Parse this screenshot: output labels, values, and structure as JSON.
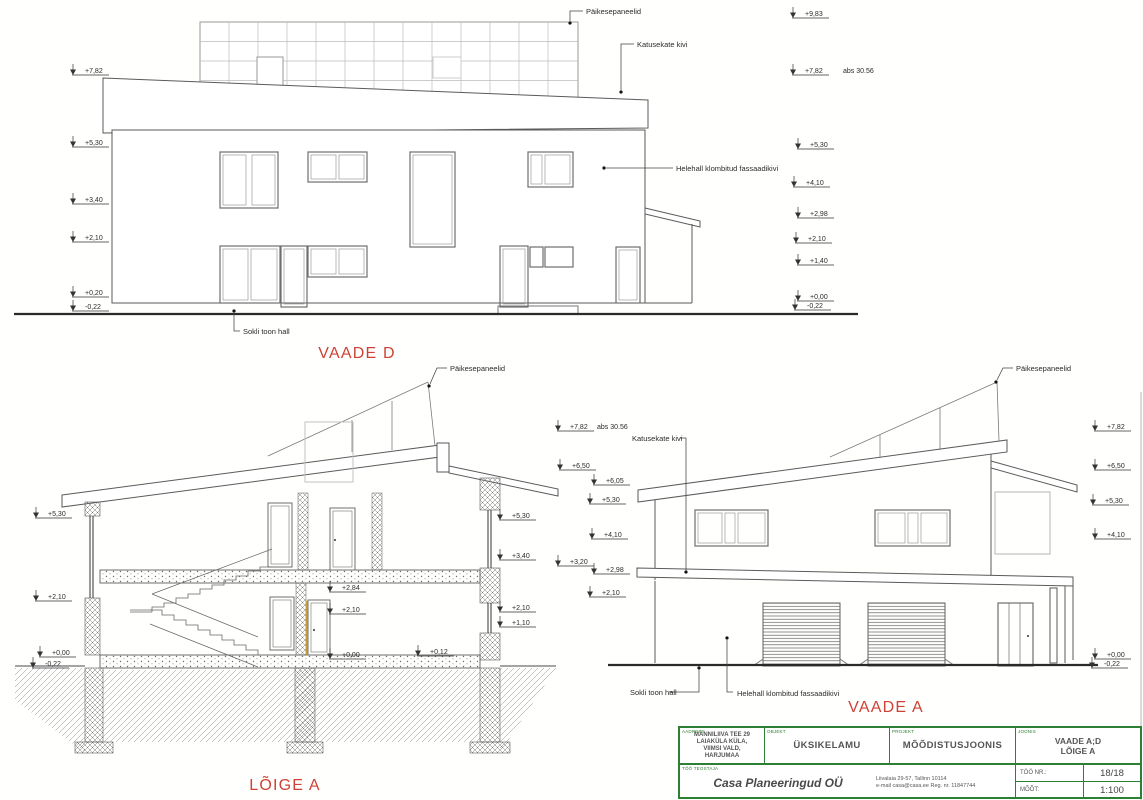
{
  "sheet": {
    "kind": "architectural measurement drawing",
    "scale": "1:100"
  },
  "colors": {
    "red_label": "#cf4136",
    "green_border": "#2c7f33",
    "line": "#5a5a5a",
    "accent_wood": "#cc9922"
  },
  "annotations": {
    "level_marks": [
      {
        "t": "+7,82",
        "x": 85,
        "y": 73
      },
      {
        "t": "+5,30",
        "x": 85,
        "y": 145
      },
      {
        "t": "+3,40",
        "x": 85,
        "y": 202
      },
      {
        "t": "+2,10",
        "x": 85,
        "y": 240
      },
      {
        "t": "+0,20",
        "x": 85,
        "y": 295
      },
      {
        "t": "-0,22",
        "x": 85,
        "y": 309
      },
      {
        "t": "+9,83",
        "x": 805,
        "y": 16
      },
      {
        "t": "+7,82",
        "x": 805,
        "y": 73
      },
      {
        "t": "+5,30",
        "x": 810,
        "y": 147
      },
      {
        "t": "+4,10",
        "x": 806,
        "y": 185
      },
      {
        "t": "+2,98",
        "x": 810,
        "y": 216
      },
      {
        "t": "+2,10",
        "x": 808,
        "y": 241
      },
      {
        "t": "+1,40",
        "x": 810,
        "y": 263
      },
      {
        "t": "+0,00",
        "x": 810,
        "y": 299
      },
      {
        "t": "-0,22",
        "x": 807,
        "y": 308
      },
      {
        "t": "+5,30",
        "x": 48,
        "y": 516
      },
      {
        "t": "+2,10",
        "x": 48,
        "y": 599
      },
      {
        "t": "+0,00",
        "x": 52,
        "y": 655
      },
      {
        "t": "-0,22",
        "x": 45,
        "y": 666
      },
      {
        "t": "+5,30",
        "x": 512,
        "y": 518
      },
      {
        "t": "+3,40",
        "x": 512,
        "y": 558
      },
      {
        "t": "+2,10",
        "x": 512,
        "y": 610
      },
      {
        "t": "+1,10",
        "x": 512,
        "y": 625
      },
      {
        "t": "+2,84",
        "x": 342,
        "y": 590
      },
      {
        "t": "+2,10",
        "x": 342,
        "y": 612
      },
      {
        "t": "+0,00",
        "x": 342,
        "y": 657
      },
      {
        "t": "+0,12",
        "x": 430,
        "y": 654
      },
      {
        "t": "+7,82",
        "x": 570,
        "y": 429
      },
      {
        "t": "+6,50",
        "x": 572,
        "y": 468
      },
      {
        "t": "+3,20",
        "x": 570,
        "y": 564
      },
      {
        "t": "+6,05",
        "x": 606,
        "y": 483
      },
      {
        "t": "+5,30",
        "x": 602,
        "y": 502
      },
      {
        "t": "+4,10",
        "x": 604,
        "y": 537
      },
      {
        "t": "+2,98",
        "x": 606,
        "y": 572
      },
      {
        "t": "+2,10",
        "x": 602,
        "y": 595
      },
      {
        "t": "+7,82",
        "x": 1107,
        "y": 429
      },
      {
        "t": "+6,50",
        "x": 1107,
        "y": 468
      },
      {
        "t": "+5,30",
        "x": 1105,
        "y": 503
      },
      {
        "t": "+4,10",
        "x": 1107,
        "y": 537
      },
      {
        "t": "+0,00",
        "x": 1107,
        "y": 657
      },
      {
        "t": "-0,22",
        "x": 1104,
        "y": 666
      }
    ],
    "labels": [
      {
        "t": "Päikesepaneelid",
        "x": 586,
        "y": 14,
        "cls": "lbl"
      },
      {
        "t": "Katusekate kivi",
        "x": 637,
        "y": 47,
        "cls": "lbl"
      },
      {
        "t": "Helehall klombitud fassaadikivi",
        "x": 676,
        "y": 171,
        "cls": "lbl"
      },
      {
        "t": "Sokli toon hall",
        "x": 243,
        "y": 334,
        "cls": "lbl"
      },
      {
        "t": "Päikesepaneelid",
        "x": 450,
        "y": 371,
        "cls": "lbl"
      },
      {
        "t": "Päikesepaneelid",
        "x": 1016,
        "y": 371,
        "cls": "lbl"
      },
      {
        "t": "Katusekate kivi",
        "x": 632,
        "y": 441,
        "cls": "lbl"
      },
      {
        "t": "Sokli toon hall",
        "x": 630,
        "y": 695,
        "cls": "lbl"
      },
      {
        "t": "Helehall klombitud fassaadikivi",
        "x": 737,
        "y": 696,
        "cls": "lbl"
      },
      {
        "t": "abs 30.56",
        "x": 843,
        "y": 73,
        "cls": "lvl"
      },
      {
        "t": "abs 30.56",
        "x": 597,
        "y": 429,
        "cls": "lvl"
      },
      {
        "t": "VAADE D",
        "x": 357,
        "y": 358,
        "cls": "ttl",
        "anchor": "middle"
      },
      {
        "t": "LÕIGE A",
        "x": 285,
        "y": 790,
        "cls": "ttl",
        "anchor": "middle"
      },
      {
        "t": "VAADE A",
        "x": 886,
        "y": 712,
        "cls": "ttl",
        "anchor": "middle"
      }
    ],
    "leaders": [
      {
        "d": "M583,11 H570 V21",
        "dot": [
          570,
          23
        ]
      },
      {
        "d": "M634,44 H621 V90",
        "dot": [
          621,
          92
        ]
      },
      {
        "d": "M673,168 H606",
        "dot": [
          604,
          168
        ]
      },
      {
        "d": "M240,331 H234 V313",
        "dot": [
          234,
          311
        ]
      },
      {
        "d": "M447,368 H437 L430,384",
        "dot": [
          429,
          386
        ]
      },
      {
        "d": "M1013,368 H1003 L997,380",
        "dot": [
          996,
          382
        ]
      },
      {
        "d": "M680,438 H686 V570",
        "dot": [
          686,
          572
        ]
      },
      {
        "d": "M669,692 H699 V670",
        "dot": [
          699,
          668
        ]
      },
      {
        "d": "M733,692 H727 V640",
        "dot": [
          727,
          638
        ]
      }
    ]
  },
  "titleblock": {
    "address_label": "AADRESS",
    "address_lines": [
      "MÄNNILIIVA TEE 29",
      "LAIAKÜLA KÜLA,",
      "VIIMSI VALD,",
      "HARJUMAA"
    ],
    "object_label": "OBJEKT",
    "object": "ÜKSIKELAMU",
    "project_label": "PROJEKT",
    "project": "MÕÕDISTUSJOONIS",
    "drawing_label": "JOONIS",
    "drawing_lines": [
      "VAADE A;D",
      "LÕIGE A"
    ],
    "author_label": "TÖÖ TEOSTAJA",
    "company": "Casa Planeeringud OÜ",
    "company_address_lines": [
      "Liivalaia 29-57, Tallinn 10114",
      "e-mail casa@casa.ee   Reg. nr. 11847744"
    ],
    "job_nr_label": "TÖÖ NR.:",
    "job_nr": "18/18",
    "scale_label": "MÕÕT:",
    "scale": "1:100"
  }
}
